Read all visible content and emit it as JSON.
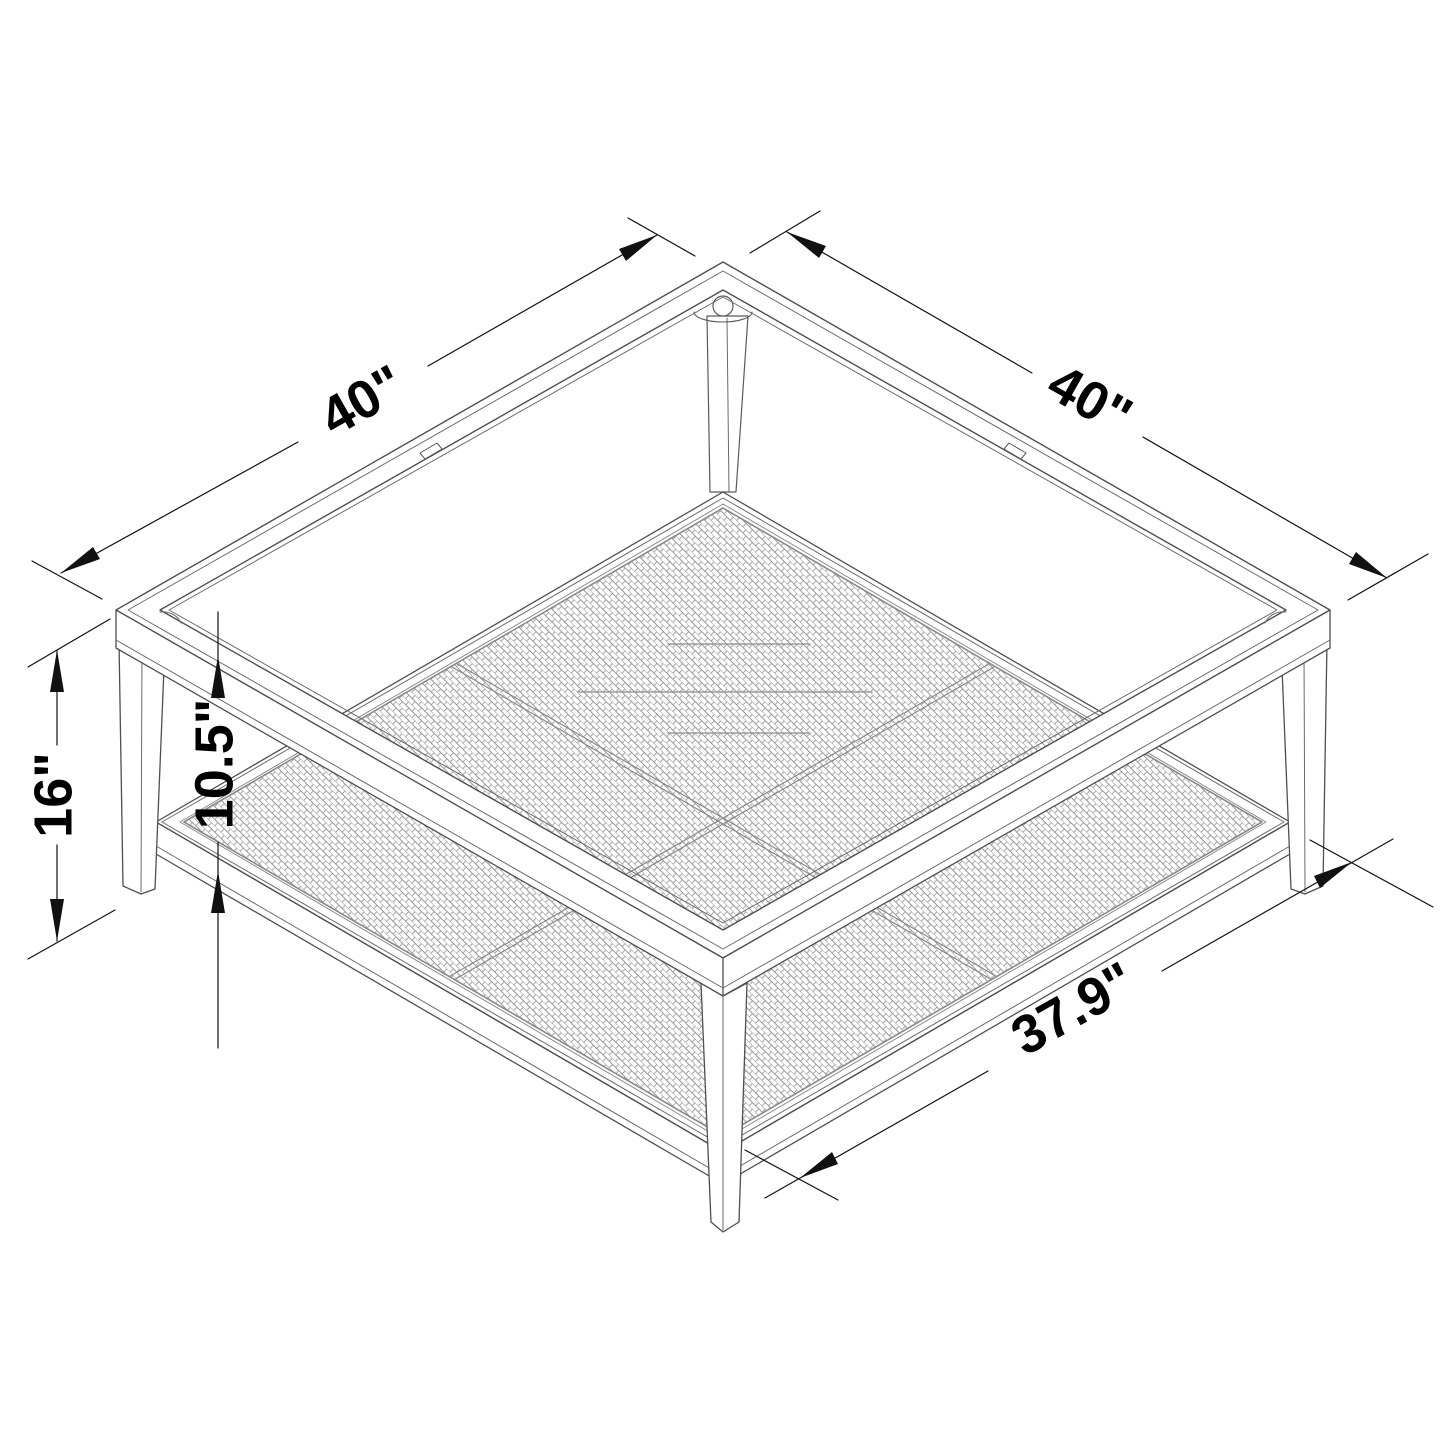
{
  "dimensions": {
    "width": "40\"",
    "depth": "40\"",
    "height": "16\"",
    "clearance": "10.5\"",
    "shelf_width": "37.9\""
  },
  "colors": {
    "background": "#ffffff",
    "table_line": "#4f4f4f",
    "light_line": "#8f8f8f",
    "weave_line": "#999999",
    "dimension_line": "#111111",
    "label_text": "#000000"
  }
}
